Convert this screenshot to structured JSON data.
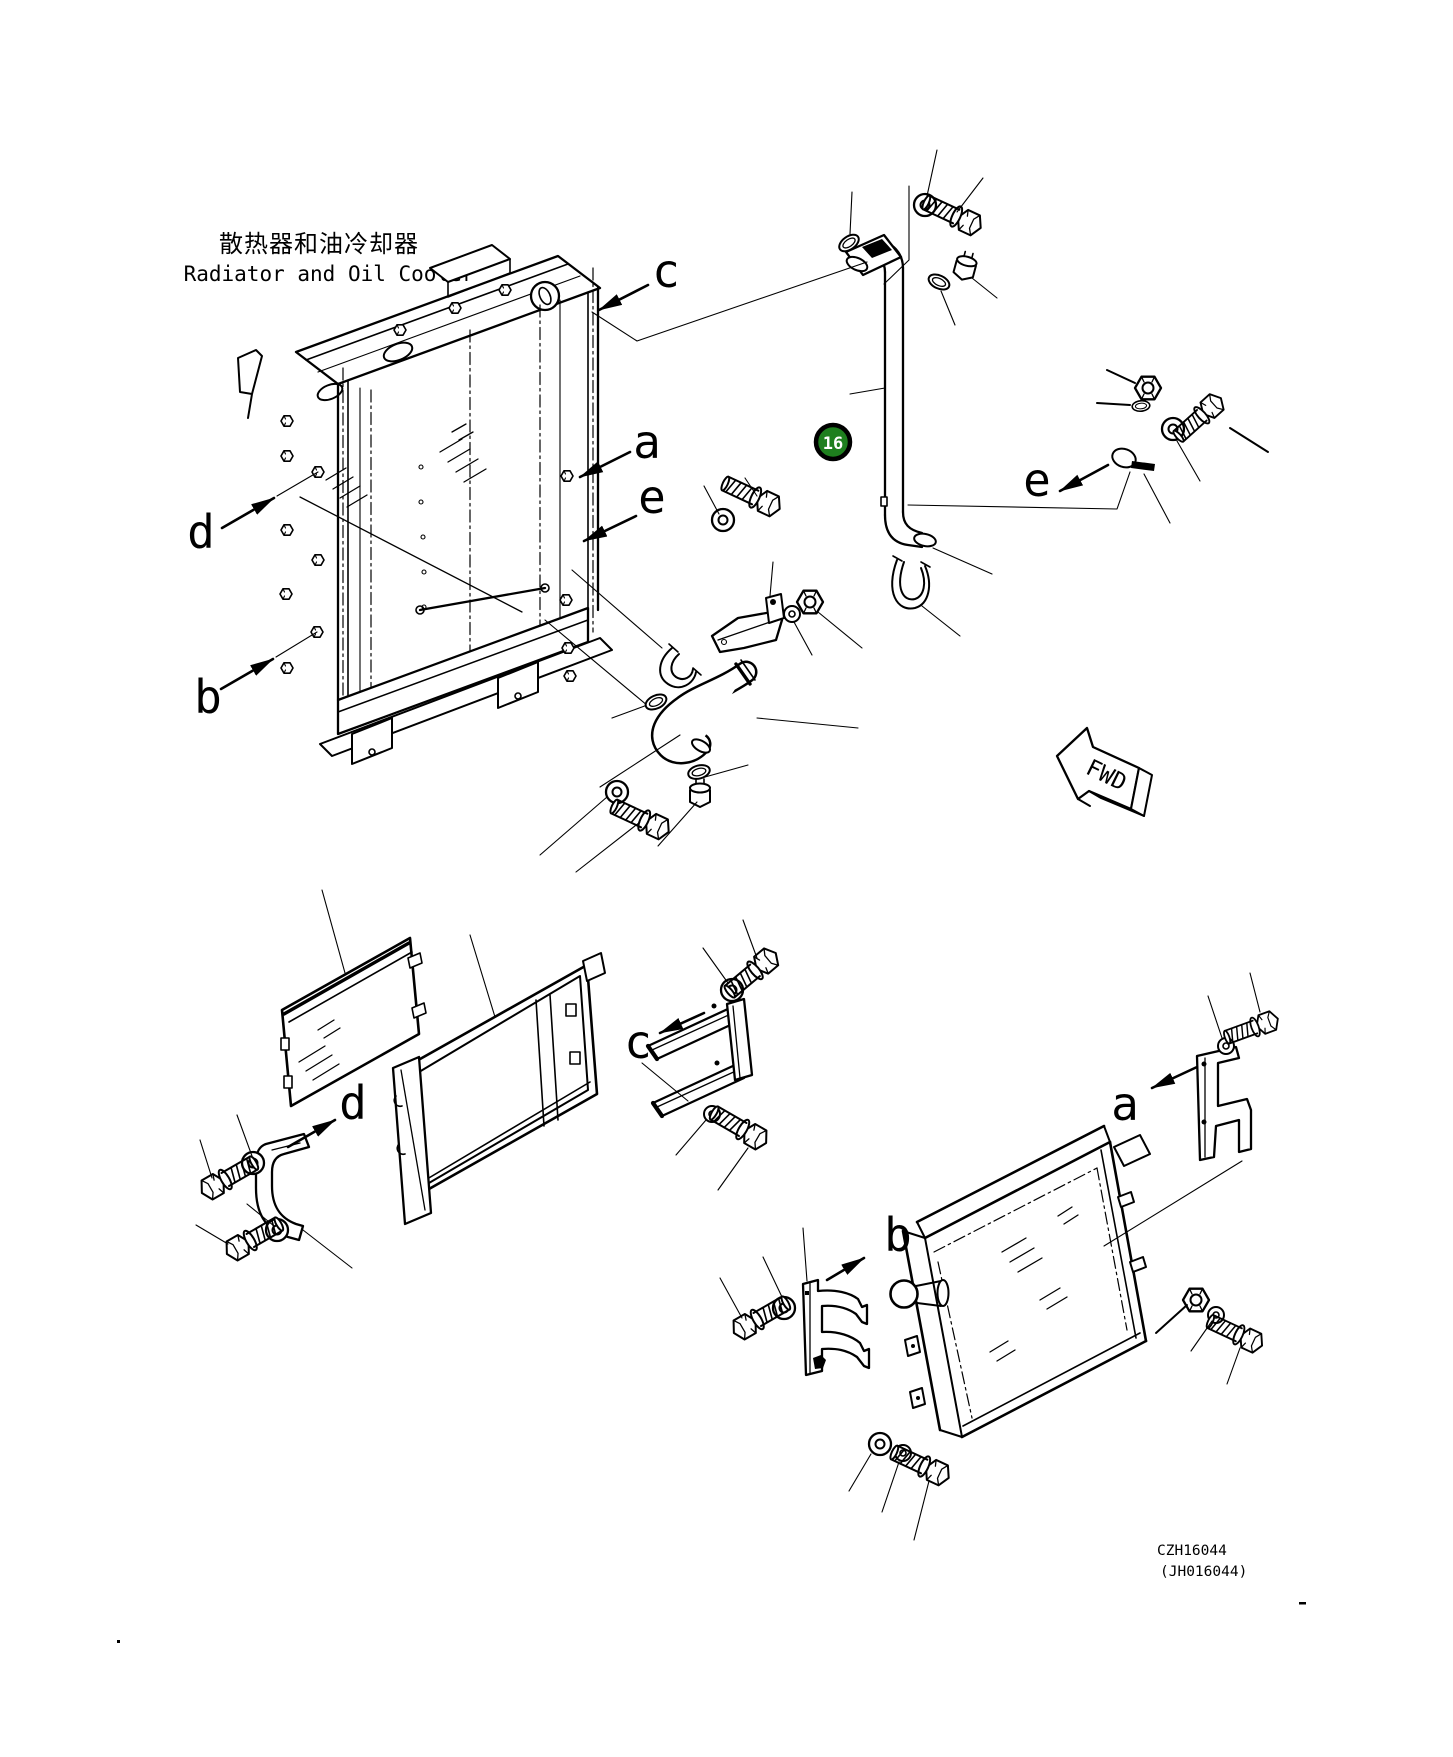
{
  "header": {
    "title_cn": "散热器和油冷却器",
    "title_en": "Radiator and Oil Cooler"
  },
  "balloon": {
    "number": "16",
    "color": "#1e7f1e"
  },
  "fwd": {
    "label": "FWD"
  },
  "drawing_code": {
    "primary": "CZH16044",
    "secondary": "(JH016044)"
  },
  "callouts": {
    "upper": {
      "c": "c",
      "a": "a",
      "e_left": "e",
      "d": "d",
      "b": "b",
      "e_right": "e"
    },
    "lower": {
      "c": "c",
      "d": "d",
      "a": "a",
      "b": "b"
    }
  }
}
